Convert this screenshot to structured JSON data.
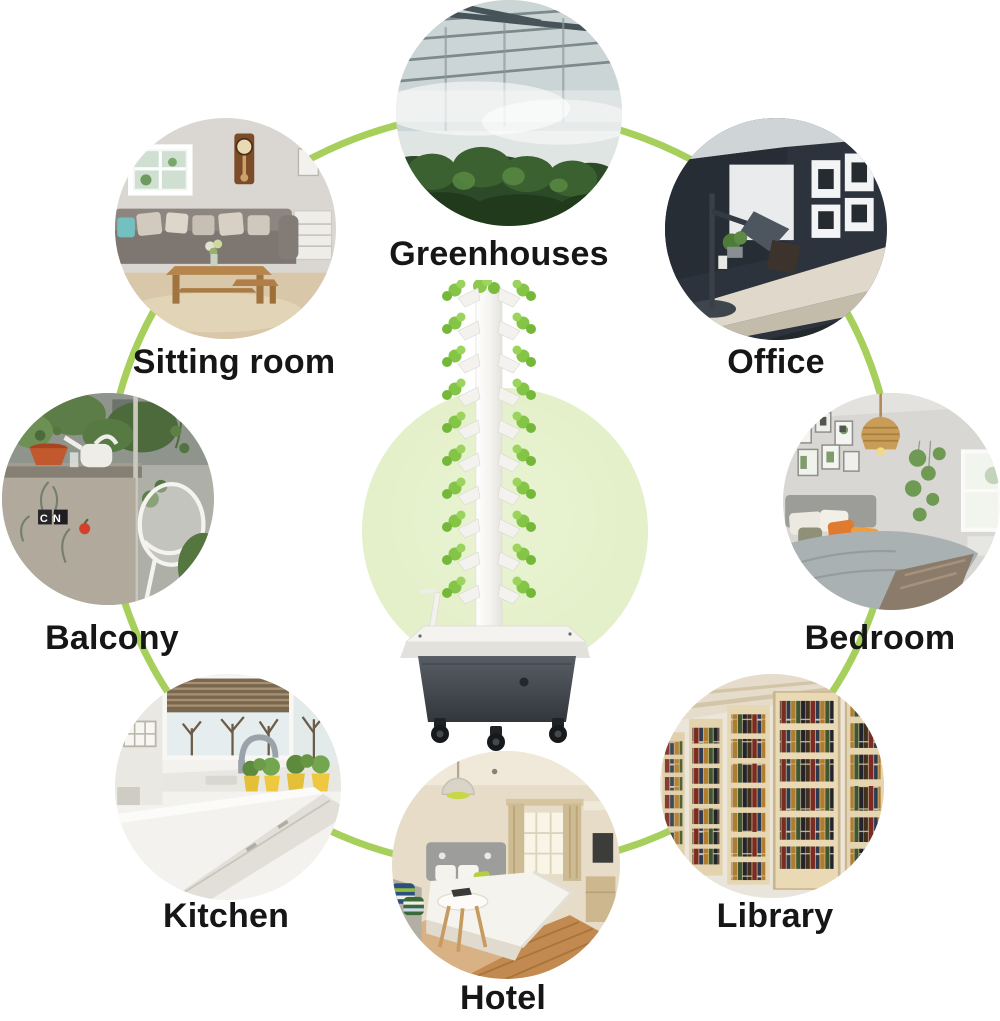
{
  "page": {
    "type_label": "product-use-case-infographic",
    "background_color": "#ffffff",
    "accent_green": "#a6cf5c",
    "center_glow_color": "#e4f0c9",
    "label_color": "#161616"
  },
  "product": {
    "photo": "hydroponic-tower-garden-with-seedlings-on-rolling-reservoir"
  },
  "scenes": [
    {
      "id": "greenhouses",
      "label": "Greenhouses",
      "photo": "greenhouse-interior-with-mist"
    },
    {
      "id": "office",
      "label": "Office",
      "photo": "dark-walled-office-desk-with-lamp"
    },
    {
      "id": "bedroom",
      "label": "Bedroom",
      "photo": "bedroom-gallery-wall-orange-pillows"
    },
    {
      "id": "library",
      "label": "Library",
      "photo": "wooden-bookshelves-with-books"
    },
    {
      "id": "hotel",
      "label": "Hotel",
      "photo": "hotel-room-bed-pendant-lamp"
    },
    {
      "id": "kitchen",
      "label": "Kitchen",
      "photo": "white-kitchen-counters-yellow-planters"
    },
    {
      "id": "balcony",
      "label": "Balcony",
      "photo": "balcony-plants-wire-chair",
      "photo_text": "CN"
    },
    {
      "id": "sitting-room",
      "label": "Sitting room",
      "photo": "living-room-sofa-clock-coffee-table"
    }
  ]
}
